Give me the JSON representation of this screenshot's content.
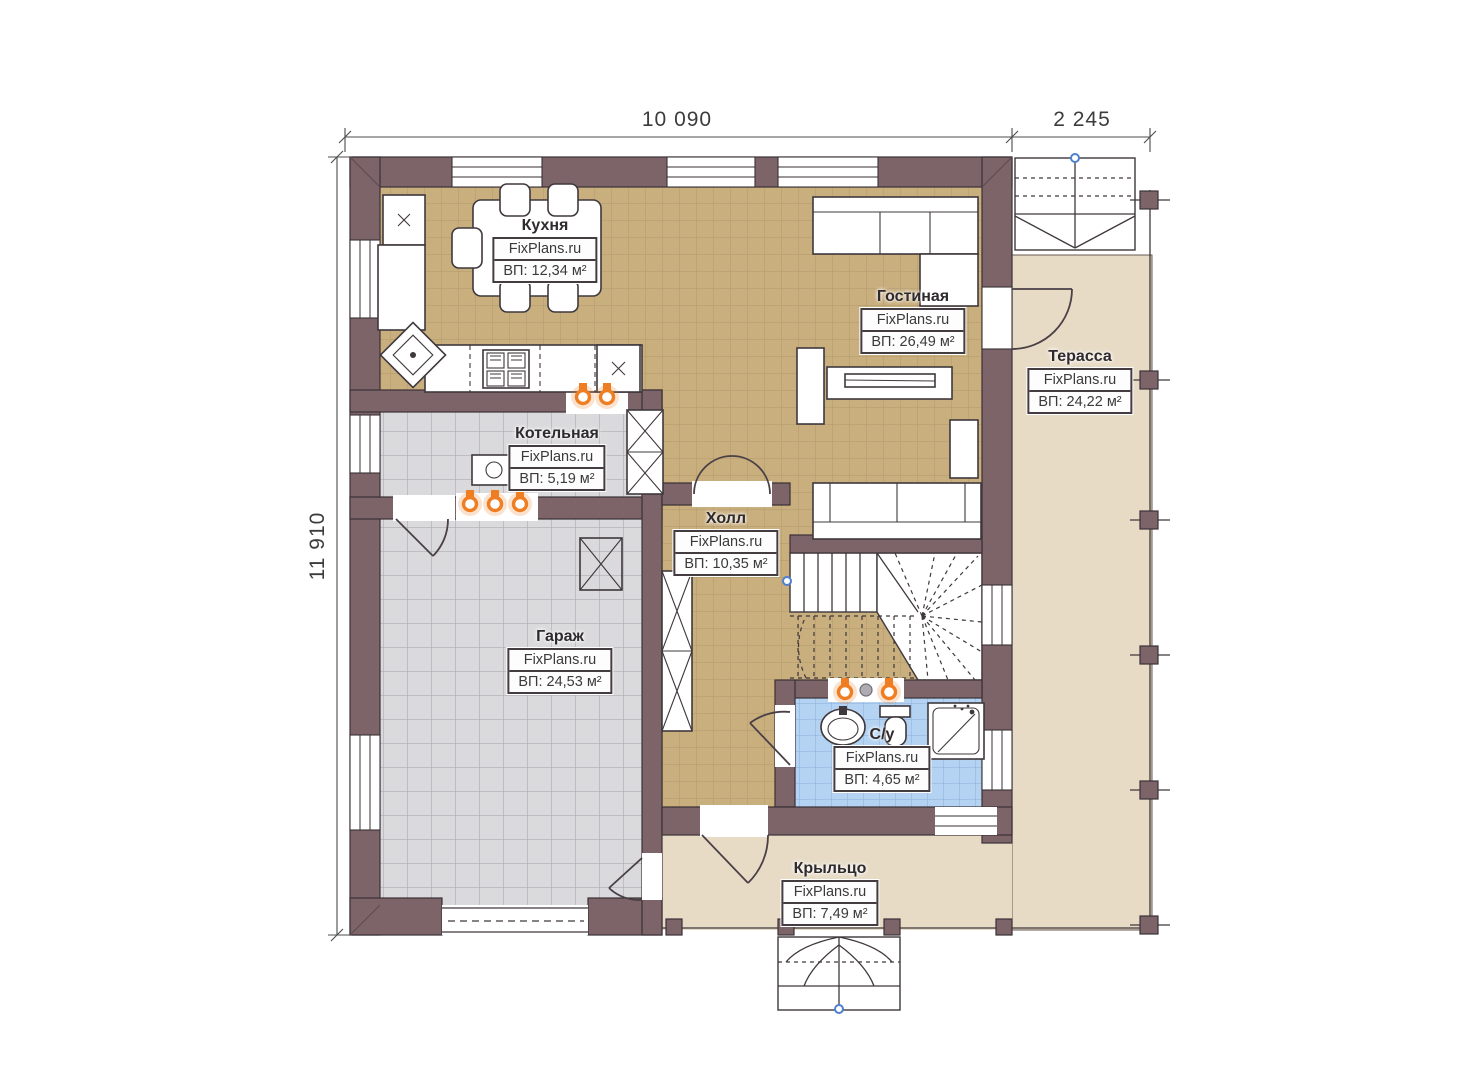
{
  "plan_title": "floor-plan-first-floor",
  "watermark": "FixPlans.ru",
  "dimensions": {
    "top_main": "10 090",
    "top_terrace": "2 245",
    "left_height": "11 910"
  },
  "rooms": [
    {
      "key": "kitchen",
      "name": "Кухня",
      "brand": "FixPlans.ru",
      "area": "ВП: 12,34 м²"
    },
    {
      "key": "living",
      "name": "Гостиная",
      "brand": "FixPlans.ru",
      "area": "ВП: 26,49 м²"
    },
    {
      "key": "terrace",
      "name": "Терасса",
      "brand": "FixPlans.ru",
      "area": "ВП: 24,22 м²"
    },
    {
      "key": "boiler",
      "name": "Котельная",
      "brand": "FixPlans.ru",
      "area": "ВП: 5,19 м²"
    },
    {
      "key": "hall",
      "name": "Холл",
      "brand": "FixPlans.ru",
      "area": "ВП: 10,35 м²"
    },
    {
      "key": "garage",
      "name": "Гараж",
      "brand": "FixPlans.ru",
      "area": "ВП: 24,53 м²"
    },
    {
      "key": "bathroom",
      "name": "С/у",
      "brand": "FixPlans.ru",
      "area": "ВП: 4,65 м²"
    },
    {
      "key": "porch",
      "name": "Крыльцо",
      "brand": "FixPlans.ru",
      "area": "ВП: 7,49 м²"
    }
  ],
  "colors": {
    "wall": "#7c6468",
    "wood_floor": "#c9ae7e",
    "gray_floor": "#dadadc",
    "bath_floor": "#b4d3f2",
    "terrace_floor": "#e7dbc6",
    "radiator": "#ef7d22"
  }
}
